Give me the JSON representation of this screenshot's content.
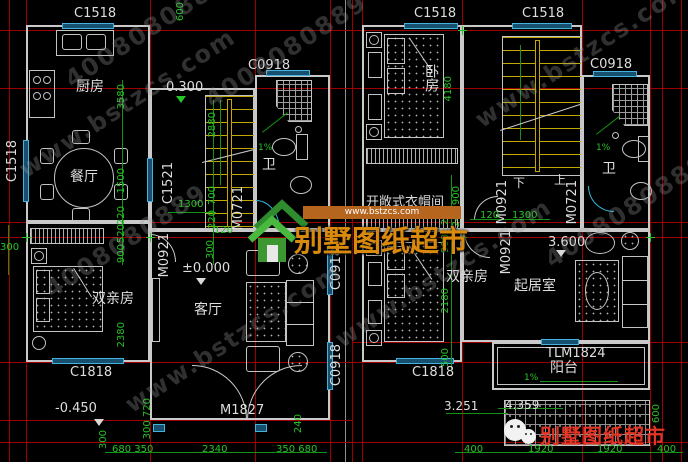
{
  "brand": {
    "site": "www.bstzcs.com",
    "phone": "4008080889",
    "name": "别墅图纸超市"
  },
  "left": {
    "kitchen": "厨房",
    "dining": "餐厅",
    "bath": "卫",
    "parents": "双亲房",
    "living": "客厅",
    "c1518_top": "C1518",
    "c1518_left": "C1518",
    "c1521": "C1521",
    "c0918_bath": "C0918",
    "c0918_a": "C0918",
    "c0918_b": "C0918",
    "c1818": "C1818",
    "m0721": "M0721",
    "m0921": "M0921",
    "m1827": "M1827",
    "lvl_0300": "0.300",
    "lvl_0000": "±0.000",
    "lvl_n0450": "-0.450",
    "slope": "1%",
    "d600": "600",
    "d300l": "300",
    "d3580": "3580",
    "d1500": "1500",
    "d220a": "220",
    "d520": "520",
    "d900": "900",
    "d2380": "2380",
    "d2880": "2880",
    "d700": "700",
    "d220b": "220",
    "d1300": "1300",
    "d120": "120",
    "d300b": "300",
    "db300": "300",
    "db300_720": "300 720",
    "db240": "240",
    "db680_350": "680 350",
    "db2340": "2340",
    "db350_680": "350 680"
  },
  "right": {
    "bedroom": "卧房",
    "closet": "开敞式衣帽间",
    "bath": "卫",
    "parents": "双亲房",
    "sitting": "起居室",
    "balcony": "阳台",
    "c1518_a": "C1518",
    "c1518_b": "C1518",
    "c0918": "C0918",
    "c1818": "C1818",
    "tlm1824": "TLM1824",
    "m0921_a": "M0921",
    "m0921_b": "M0921",
    "m0721": "M0721",
    "up": "上",
    "down": "下",
    "slope": "1%",
    "slope_balcony": "1%",
    "lvl_3600": "3.600",
    "lvl_3251": "3.251",
    "lvl_4359": "4.359",
    "d4180": "4180",
    "d240_900": "240 900",
    "d120": "120",
    "d1300": "1300",
    "d220": "220",
    "d900": "900",
    "d2180": "2180",
    "d500": "500",
    "db400a": "400",
    "db1920a": "1920",
    "db1920b": "1920",
    "db400b": "400",
    "d600": "600"
  }
}
